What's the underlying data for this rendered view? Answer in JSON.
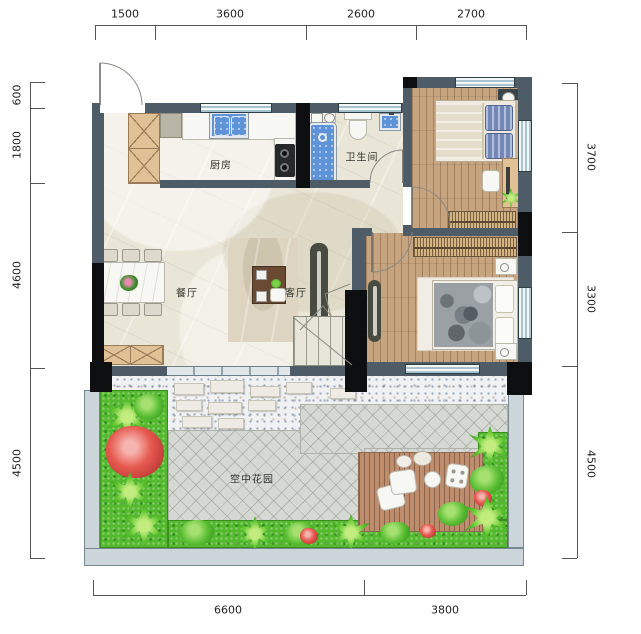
{
  "dimensions": {
    "top": [
      "1500",
      "3600",
      "2600",
      "2700"
    ],
    "left": [
      "600",
      "1800",
      "4600",
      "4500"
    ],
    "right": [
      "3700",
      "3300",
      "4500"
    ],
    "bottom": [
      "6600",
      "3800"
    ]
  },
  "rooms": {
    "kitchen": "厨房",
    "bathroom": "卫生间",
    "dining": "餐厅",
    "living": "客厅",
    "sky_garden": "空中花园"
  },
  "colors": {
    "wall": "#4d5c66",
    "column": "#0e0f10",
    "marble_floor": "#e9e6d7",
    "wood_floor": "#c6a480",
    "deck_wood": "#bd8d6e",
    "garden_tile": "#d6d9d3",
    "grass": "#54b92e",
    "water_fixture_blue": "#5f93d8",
    "window_glass": "#a9c3cd",
    "red_flowers": "#e65a50"
  }
}
